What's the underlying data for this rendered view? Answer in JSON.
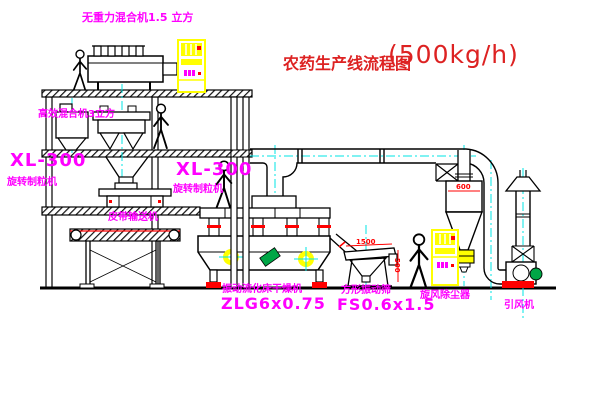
{
  "title": {
    "text": "农药生产线流程图",
    "capacity": "(500kg/h)"
  },
  "labels": {
    "top_mixer": "无重力混合机1.5 立方",
    "floor2_mixer": "高效混合机3立方",
    "mill_left_model": "XL-300",
    "mill_left_name": "旋转制粒机",
    "granulator_model": "XL-300",
    "granulator_name": "旋转制粒机",
    "belt_conveyor": "皮带输送机",
    "dryer_name": "振动流化床干燥机",
    "dryer_model": "ZLG6x0.75",
    "sieve_name": "方形振动筛",
    "sieve_model": "FS0.6x1.5",
    "cyclone_name": "旋风除尘器",
    "fan_name": "引风机"
  },
  "dimensions": {
    "cyclone_dia": "600",
    "sieve_len": "1500",
    "sieve_h": "500"
  },
  "colors": {
    "label_magenta": "#FF00FF",
    "title_red": "#DD2222",
    "accent_red": "#FF0000",
    "centerline_cyan": "#00E5E5",
    "equipment_yellow": "#FFFF00",
    "motor_green": "#00A646",
    "line_black": "#000000"
  }
}
